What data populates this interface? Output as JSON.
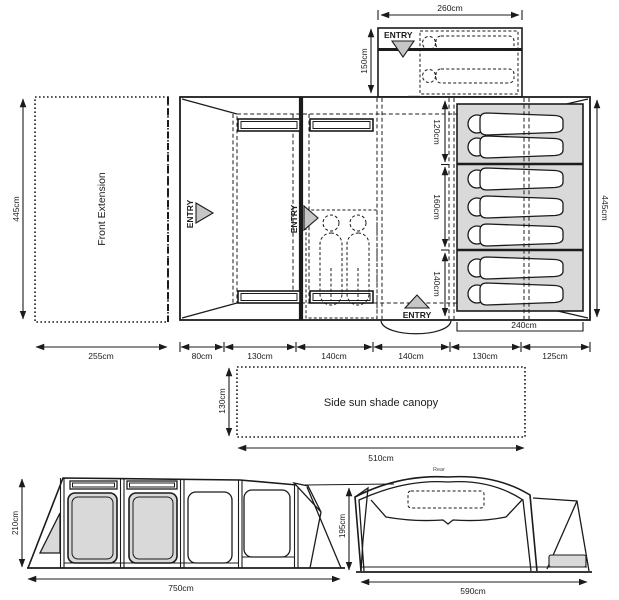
{
  "colors": {
    "line": "#1b1b1b",
    "gray_fill": "#d9d9d9",
    "triangle_fill": "#c6c6c6"
  },
  "labels": {
    "entry": "ENTRY",
    "front_extension": "Front Extension",
    "canopy": "Side sun shade canopy",
    "rear": "Rear"
  },
  "dimensions": {
    "annex_width": "260cm",
    "annex_depth": "150cm",
    "plan_height_left": "445cm",
    "plan_height_right": "445cm",
    "front_extension_width": "255cm",
    "plan_widths": [
      "80cm",
      "130cm",
      "140cm",
      "140cm",
      "130cm",
      "125cm"
    ],
    "bedroom_heights": [
      "120cm",
      "160cm",
      "140cm"
    ],
    "bedroom_width": "240cm",
    "canopy_depth": "130cm",
    "canopy_width": "510cm",
    "side_height": "210cm",
    "side_width": "750cm",
    "rear_height": "195cm",
    "rear_width": "590cm"
  },
  "sleeping_positions": {
    "annex_sleepers": 2,
    "bedroom_sections": [
      2,
      3,
      2
    ],
    "standing_figures": 2
  }
}
